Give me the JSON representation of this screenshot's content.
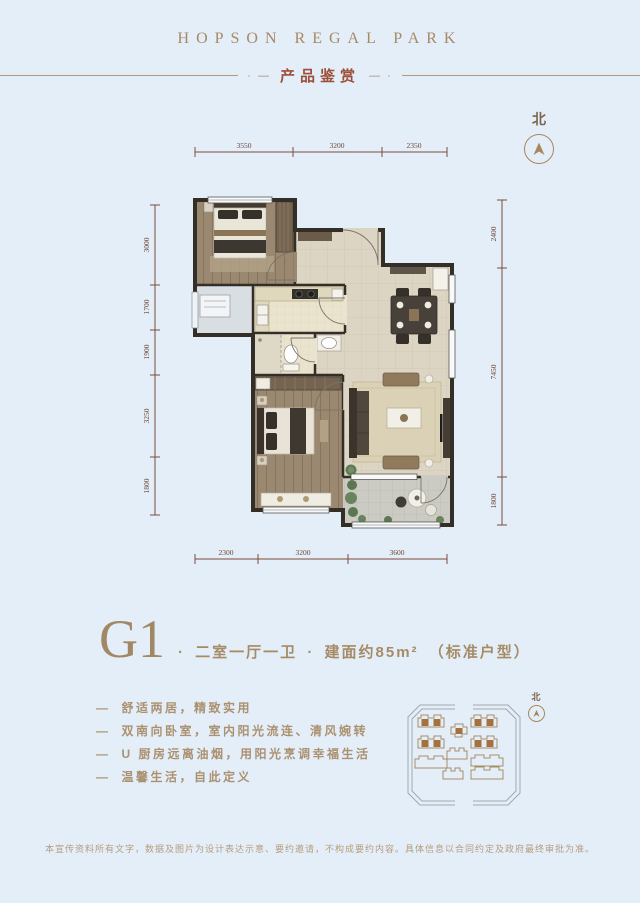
{
  "page": {
    "background_color": "#e4eef9"
  },
  "header": {
    "brand": "HOPSON REGAL PARK",
    "left_mark": "· —",
    "section_title": "产品鉴赏",
    "right_mark": "— ·"
  },
  "compass": {
    "label": "北"
  },
  "floor_plan": {
    "dims_top": [
      "3550",
      "3200",
      "2350"
    ],
    "dims_left": [
      "3000",
      "1700",
      "1900",
      "3250",
      "1800"
    ],
    "dims_right": [
      "2400",
      "7450",
      "1800"
    ],
    "dims_bottom": [
      "2300",
      "3200",
      "3600"
    ]
  },
  "unit": {
    "code": "G1",
    "sep": "·",
    "layout": "二室一厅一卫",
    "area": "建面约85m²",
    "note": "（标准户型）",
    "feature_dash": "—"
  },
  "features": [
    "舒适两居，精致实用",
    "双南向卧室，室内阳光流连、清风婉转",
    "U 厨房远离油烟，用阳光烹调幸福生活",
    "温馨生活，自此定义"
  ],
  "site_plan": {
    "compass_label": "北"
  },
  "footer": {
    "disclaimer": "本宣传资料所有文字，数据及图片为设计表达示意、要约邀请，不构成要约内容。具体信息以合同约定及政府最终审批为准。"
  },
  "colors": {
    "accent_tan": "#a98e68",
    "accent_red": "#9c4f38",
    "dimension_line": "#7d4a37",
    "highlight_building": "#a5713d"
  }
}
